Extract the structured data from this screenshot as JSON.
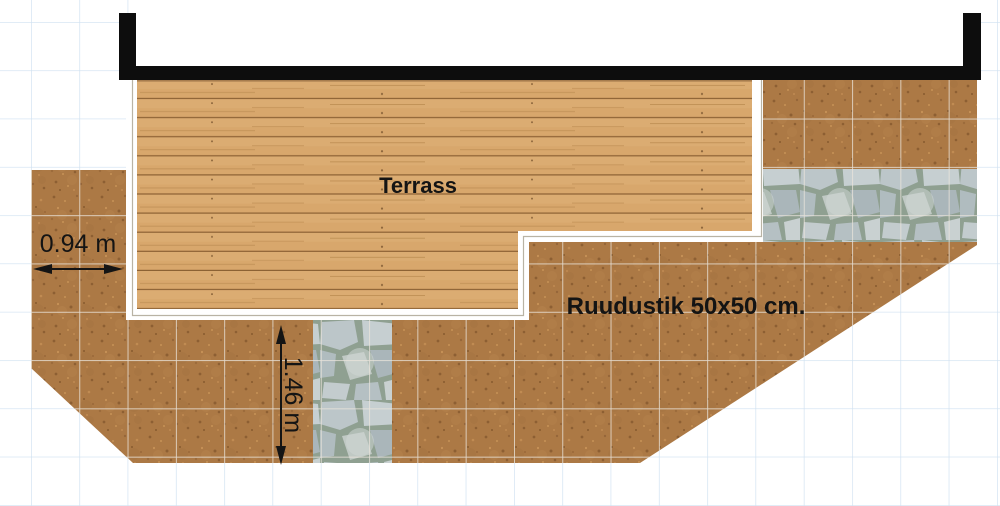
{
  "plan": {
    "terrace_label": "Terrass",
    "grid_label": "Ruudustik 50x50 cm.",
    "dim_horizontal": "0.94 m",
    "dim_vertical": "1.46 m"
  },
  "legend": {
    "grid_cell_size": "50x50 cm",
    "left_strip_width": "0.94 m",
    "bottom_path_length": "1.46 m"
  },
  "colors": {
    "background": "#ffffff",
    "blueprint_grid": "#cfe1f1",
    "soil": "#ac7945",
    "soil_grid": "#eae5dc",
    "wood": "#d8a76c",
    "wood_line": "#8c6134",
    "stone": "#bcc6c9",
    "stone_joint": "#8fa091",
    "wall": "#0d0d0d",
    "terrace_border": "#ffffff",
    "terrace_border_line": "#b9b3a4",
    "dimension": "#141414",
    "text": "#141414"
  }
}
